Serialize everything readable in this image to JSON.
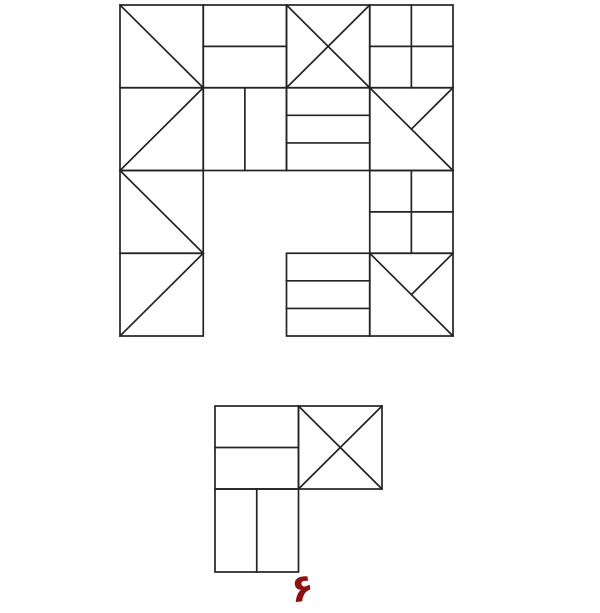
{
  "canvas": {
    "width": 600,
    "height": 613,
    "background_color": "#ffffff",
    "line_color": "#242424",
    "line_width": 1.7
  },
  "patterns": {
    "diag-tlbr": {
      "description": "single diagonal from top-left to bottom-right",
      "segments": [
        [
          0,
          0,
          1,
          1
        ]
      ]
    },
    "diag-trbl": {
      "description": "single diagonal from top-right to bottom-left",
      "segments": [
        [
          1,
          0,
          0,
          1
        ]
      ]
    },
    "cross": {
      "description": "X cross, both diagonals",
      "segments": [
        [
          0,
          0,
          1,
          1
        ],
        [
          1,
          0,
          0,
          1
        ]
      ]
    },
    "hsplit": {
      "description": "horizontal line at middle",
      "segments": [
        [
          0,
          0.5,
          1,
          0.5
        ]
      ]
    },
    "vsplit": {
      "description": "vertical line at middle",
      "segments": [
        [
          0.5,
          0,
          0.5,
          1
        ]
      ]
    },
    "grid2x2": {
      "description": "2x2 window pane: vertical and horizontal mid lines",
      "segments": [
        [
          0,
          0.5,
          1,
          0.5
        ],
        [
          0.5,
          0,
          0.5,
          1
        ]
      ]
    },
    "hthirds": {
      "description": "two horizontal lines dividing cell in three strips",
      "segments": [
        [
          0,
          0.3333,
          1,
          0.3333
        ],
        [
          0,
          0.6667,
          1,
          0.6667
        ]
      ]
    },
    "diag-tlbr-half": {
      "description": "full diagonal top-left to bottom-right plus half diagonal from top-right to center",
      "segments": [
        [
          0,
          0,
          1,
          1
        ],
        [
          1,
          0,
          0.5,
          0.5
        ]
      ]
    }
  },
  "figures": [
    {
      "name": "main-figure",
      "origin_x": 120,
      "origin_y": 5,
      "cell_width": 83.25,
      "cell_height": 82.75,
      "cells": [
        {
          "row": 0,
          "col": 0,
          "pattern": "diag-tlbr"
        },
        {
          "row": 0,
          "col": 1,
          "pattern": "hsplit"
        },
        {
          "row": 0,
          "col": 2,
          "pattern": "cross"
        },
        {
          "row": 0,
          "col": 3,
          "pattern": "grid2x2"
        },
        {
          "row": 1,
          "col": 0,
          "pattern": "diag-trbl"
        },
        {
          "row": 1,
          "col": 1,
          "pattern": "vsplit"
        },
        {
          "row": 1,
          "col": 2,
          "pattern": "hthirds"
        },
        {
          "row": 1,
          "col": 3,
          "pattern": "diag-tlbr-half"
        },
        {
          "row": 2,
          "col": 0,
          "pattern": "diag-tlbr"
        },
        {
          "row": 2,
          "col": 3,
          "pattern": "grid2x2"
        },
        {
          "row": 3,
          "col": 0,
          "pattern": "diag-trbl"
        },
        {
          "row": 3,
          "col": 2,
          "pattern": "hthirds"
        },
        {
          "row": 3,
          "col": 3,
          "pattern": "diag-tlbr-half"
        }
      ]
    },
    {
      "name": "answer-figure",
      "origin_x": 215,
      "origin_y": 406,
      "cell_width": 83.5,
      "cell_height": 83,
      "cells": [
        {
          "row": 0,
          "col": 0,
          "pattern": "hsplit"
        },
        {
          "row": 0,
          "col": 1,
          "pattern": "cross"
        },
        {
          "row": 1,
          "col": 0,
          "pattern": "vsplit"
        }
      ]
    }
  ],
  "label": {
    "text": "۶",
    "color": "#8c1212",
    "x": 304,
    "y": 601,
    "font_size": 38,
    "rotation": -8
  }
}
